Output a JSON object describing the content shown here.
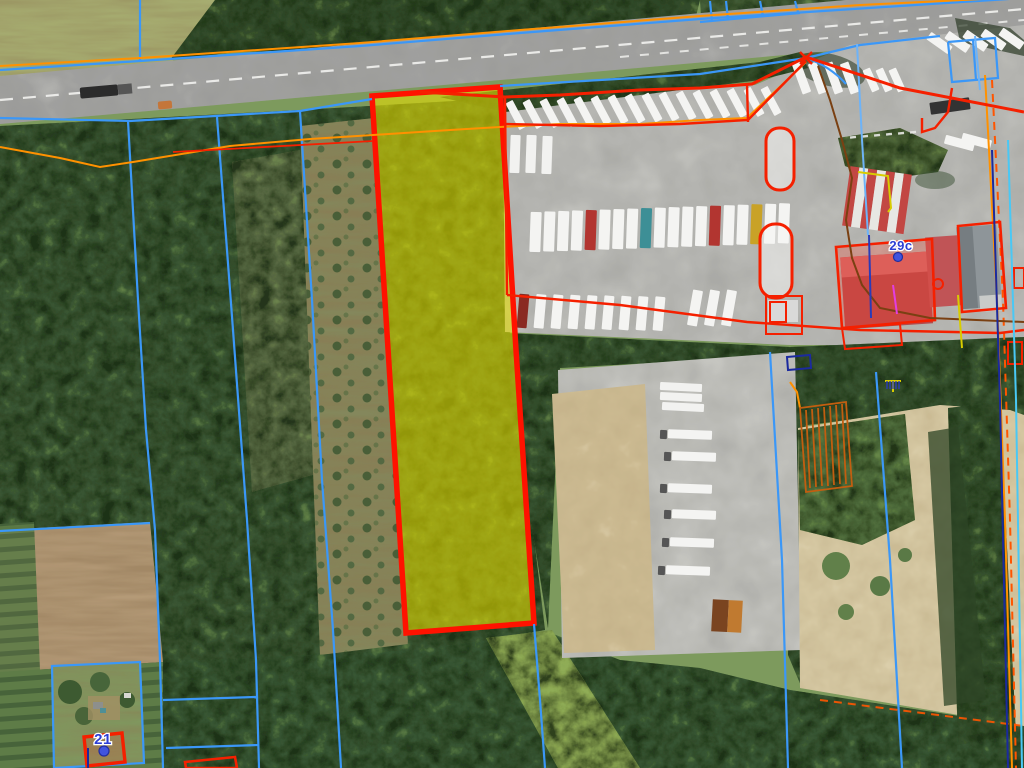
{
  "map": {
    "view": "aerial-orthophoto-with-cadastral-overlay",
    "labels": {
      "l29c": "29c",
      "l21": "21"
    },
    "address_markers": [
      {
        "id": "29c",
        "text": "29c"
      },
      {
        "id": "21",
        "text": "21"
      }
    ],
    "highlighted_parcel": {
      "fill": "#e8e000",
      "fill_opacity": 0.58,
      "border": "#ff1200"
    },
    "colors": {
      "cadastral_boundary_blue": "#3b97f7",
      "property_outline_red": "#f52000",
      "selected_parcel_fill": "#e8e000",
      "selected_parcel_border": "#ff1200",
      "utility_orange": "#ff9100",
      "utility_brown": "#7a4012",
      "utility_navy": "#1b2a9e",
      "utility_cyan": "#49c8f5",
      "utility_yellow": "#d8cc00",
      "utility_magenta": "#e23de2",
      "marker_dot_blue": "#4054de"
    }
  }
}
